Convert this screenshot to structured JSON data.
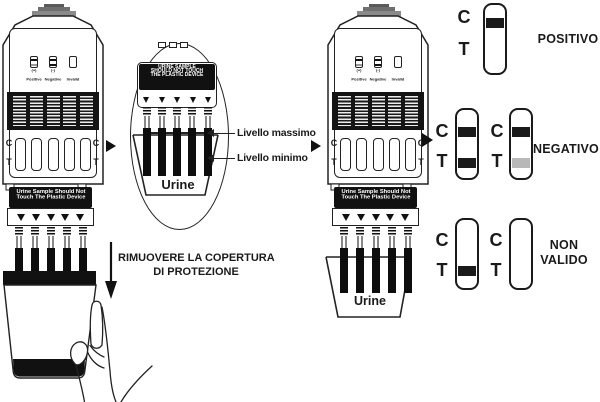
{
  "instructions": {
    "remove_cover_line1": "RIMUOVERE LA  COPERTURA",
    "remove_cover_line2": "DI PROTEZIONE"
  },
  "magnifier": {
    "warning_line1": "URINE SAMPLE",
    "warning_line2": "SHOULD NOT TOUCH",
    "warning_line3": "THE PLASTIC DEVICE",
    "level_max_label": "Livello massimo",
    "level_min_label": "Livello minimo",
    "urine_label": "Urine"
  },
  "device": {
    "warning_line1": "Urine Sample Should Not",
    "warning_line2": "Touch The Plastic Device",
    "icons": {
      "positive": "Positive",
      "negative": "Negative",
      "invalid": "Invalid",
      "positive_symbol": "(+)",
      "negative_symbol": "(-)"
    },
    "c": "C",
    "t": "T"
  },
  "cup": {
    "urine_label": "Urine"
  },
  "results": {
    "c": "C",
    "t": "T",
    "positive_label": "POSITIVO",
    "negative_label": "NEGATIVO",
    "invalid_label_line1": "NON",
    "invalid_label_line2": "VALIDO"
  },
  "colors": {
    "ink": "#1a1a1a",
    "faint_band": "#b8b8b8",
    "cap_gray": "#8a8a8a"
  }
}
